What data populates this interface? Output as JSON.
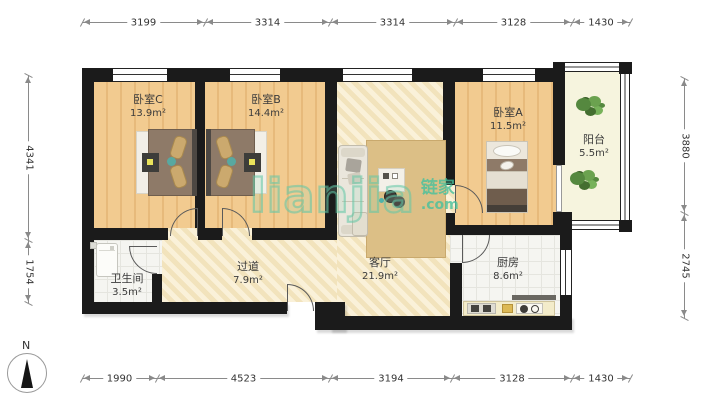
{
  "watermark": {
    "latin": "lianjia",
    "cn": "链家",
    "tld": ".com"
  },
  "compass": {
    "north_label": "N"
  },
  "rooms": {
    "bedroom_c": {
      "name": "卧室C",
      "area": "13.9m²"
    },
    "bedroom_b": {
      "name": "卧室B",
      "area": "14.4m²"
    },
    "bedroom_a": {
      "name": "卧室A",
      "area": "11.5m²"
    },
    "balcony": {
      "name": "阳台",
      "area": "5.5m²"
    },
    "bathroom": {
      "name": "卫生间",
      "area": "3.5m²"
    },
    "hallway": {
      "name": "过道",
      "area": "7.9m²"
    },
    "living_room": {
      "name": "客厅",
      "area": "21.9m²"
    },
    "kitchen": {
      "name": "厨房",
      "area": "8.6m²"
    }
  },
  "dimensions_mm": {
    "top": [
      "3199",
      "3314",
      "3314",
      "3128",
      "1430"
    ],
    "bottom": [
      "1990",
      "4523",
      "3194",
      "3128",
      "1430"
    ],
    "left": [
      "4341",
      "1754"
    ],
    "right": [
      "3880",
      "2745"
    ]
  },
  "colors": {
    "wall": "#1b1b1b",
    "wood_floor": "#f0c78c",
    "living_floor": "#f8ecca",
    "tile_floor": "#f5f5f1",
    "balcony_floor": "#f6f4de",
    "watermark_green": "#4cc3a0",
    "plant_green": "#55883f",
    "rug": "#dcbf86"
  }
}
